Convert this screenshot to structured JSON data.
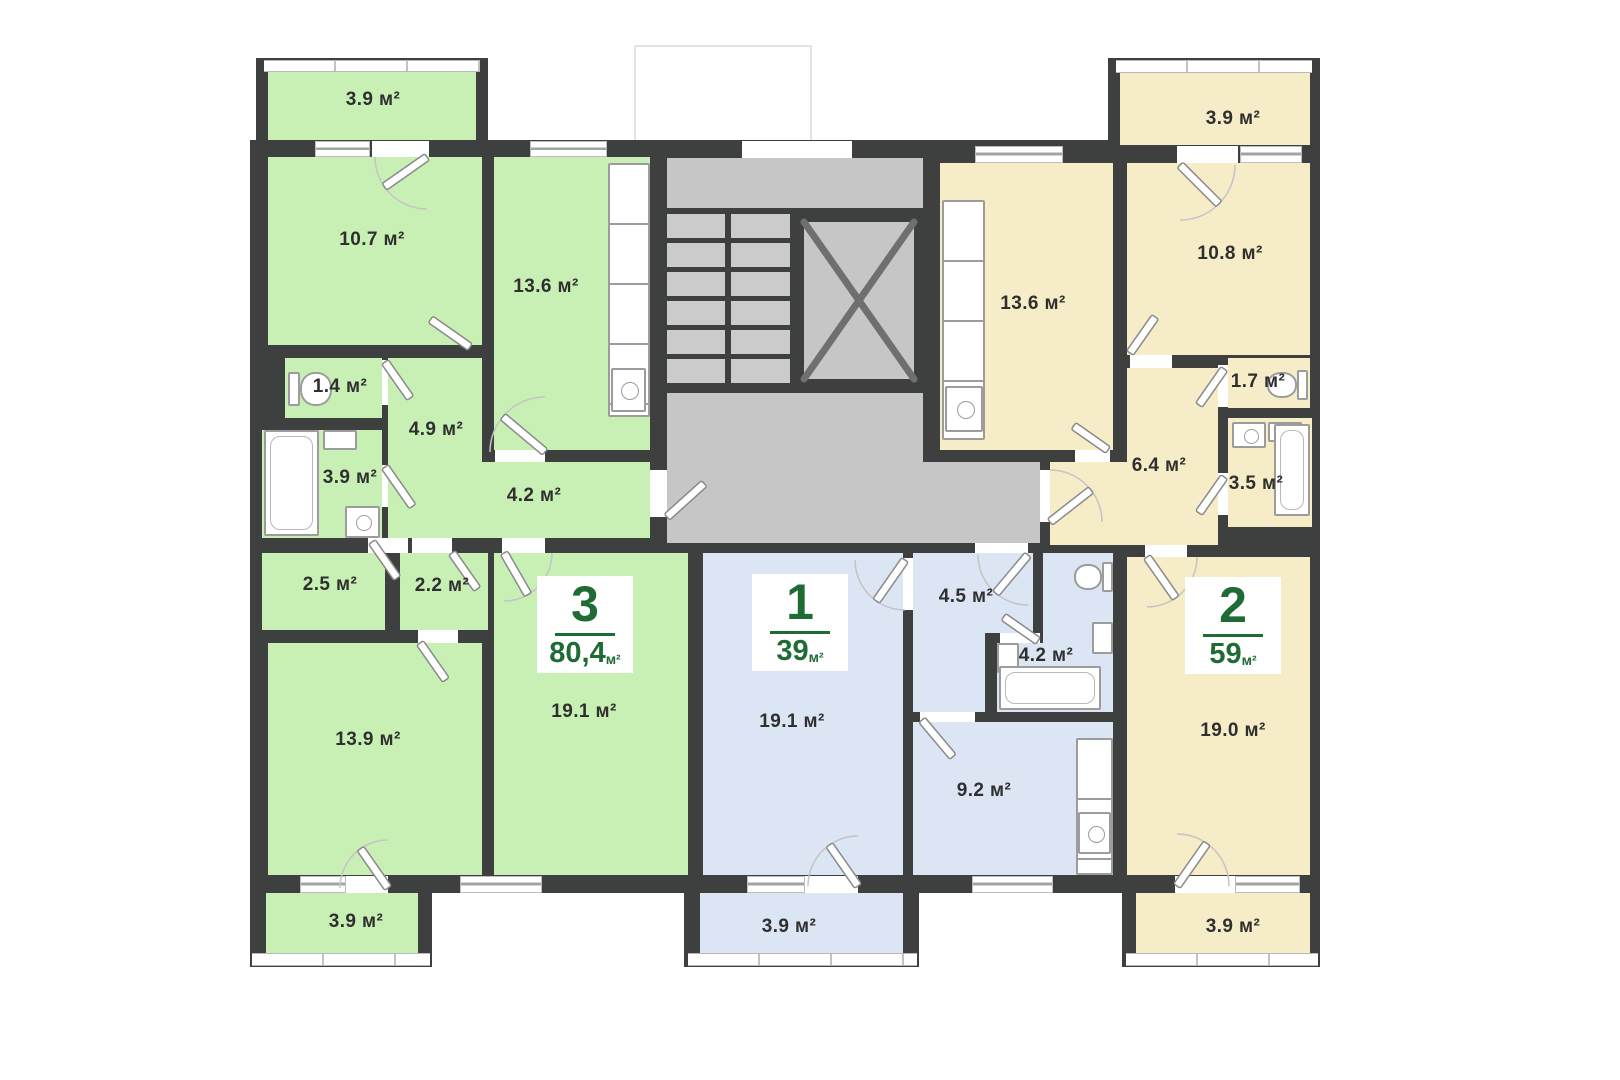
{
  "plan_type": "apartment-floor-plan",
  "unit": "м²",
  "colors": {
    "apartment_3_fill": "#c9f0b4",
    "apartment_1_fill": "#dbe5f4",
    "apartment_2_fill": "#f6ecc7",
    "walls": "#3e3f3f",
    "common_area": "#c6c6c6",
    "accent_green": "#1e6b34"
  },
  "apartments": {
    "green": {
      "badge": {
        "number": "3",
        "area": "80,4",
        "unit": "м²"
      },
      "rooms": {
        "balcony_top": "3.9 м²",
        "bedroom": "10.7 м²",
        "kitchen": "13.6 м²",
        "wc": "1.4 м²",
        "hall": "4.9 м²",
        "bathroom": "3.9 м²",
        "corridor": "4.2 м²",
        "storage_1": "2.5 м²",
        "storage_2": "2.2 м²",
        "bedroom_2": "13.9 м²",
        "living": "19.1 м²",
        "balcony_bottom": "3.9 м²"
      }
    },
    "blue": {
      "badge": {
        "number": "1",
        "area": "39",
        "unit": "м²"
      },
      "rooms": {
        "living": "19.1 м²",
        "hall": "4.5 м²",
        "bathroom": "4.2 м²",
        "kitchen": "9.2 м²",
        "balcony": "3.9 м²"
      }
    },
    "yellow": {
      "badge": {
        "number": "2",
        "area": "59",
        "unit": "м²"
      },
      "rooms": {
        "balcony_top": "3.9 м²",
        "bedroom": "10.8 м²",
        "kitchen": "13.6 м²",
        "wc": "1.7 м²",
        "hall": "6.4 м²",
        "bathroom": "3.5 м²",
        "living": "19.0 м²",
        "balcony_bottom": "3.9 м²"
      }
    }
  }
}
